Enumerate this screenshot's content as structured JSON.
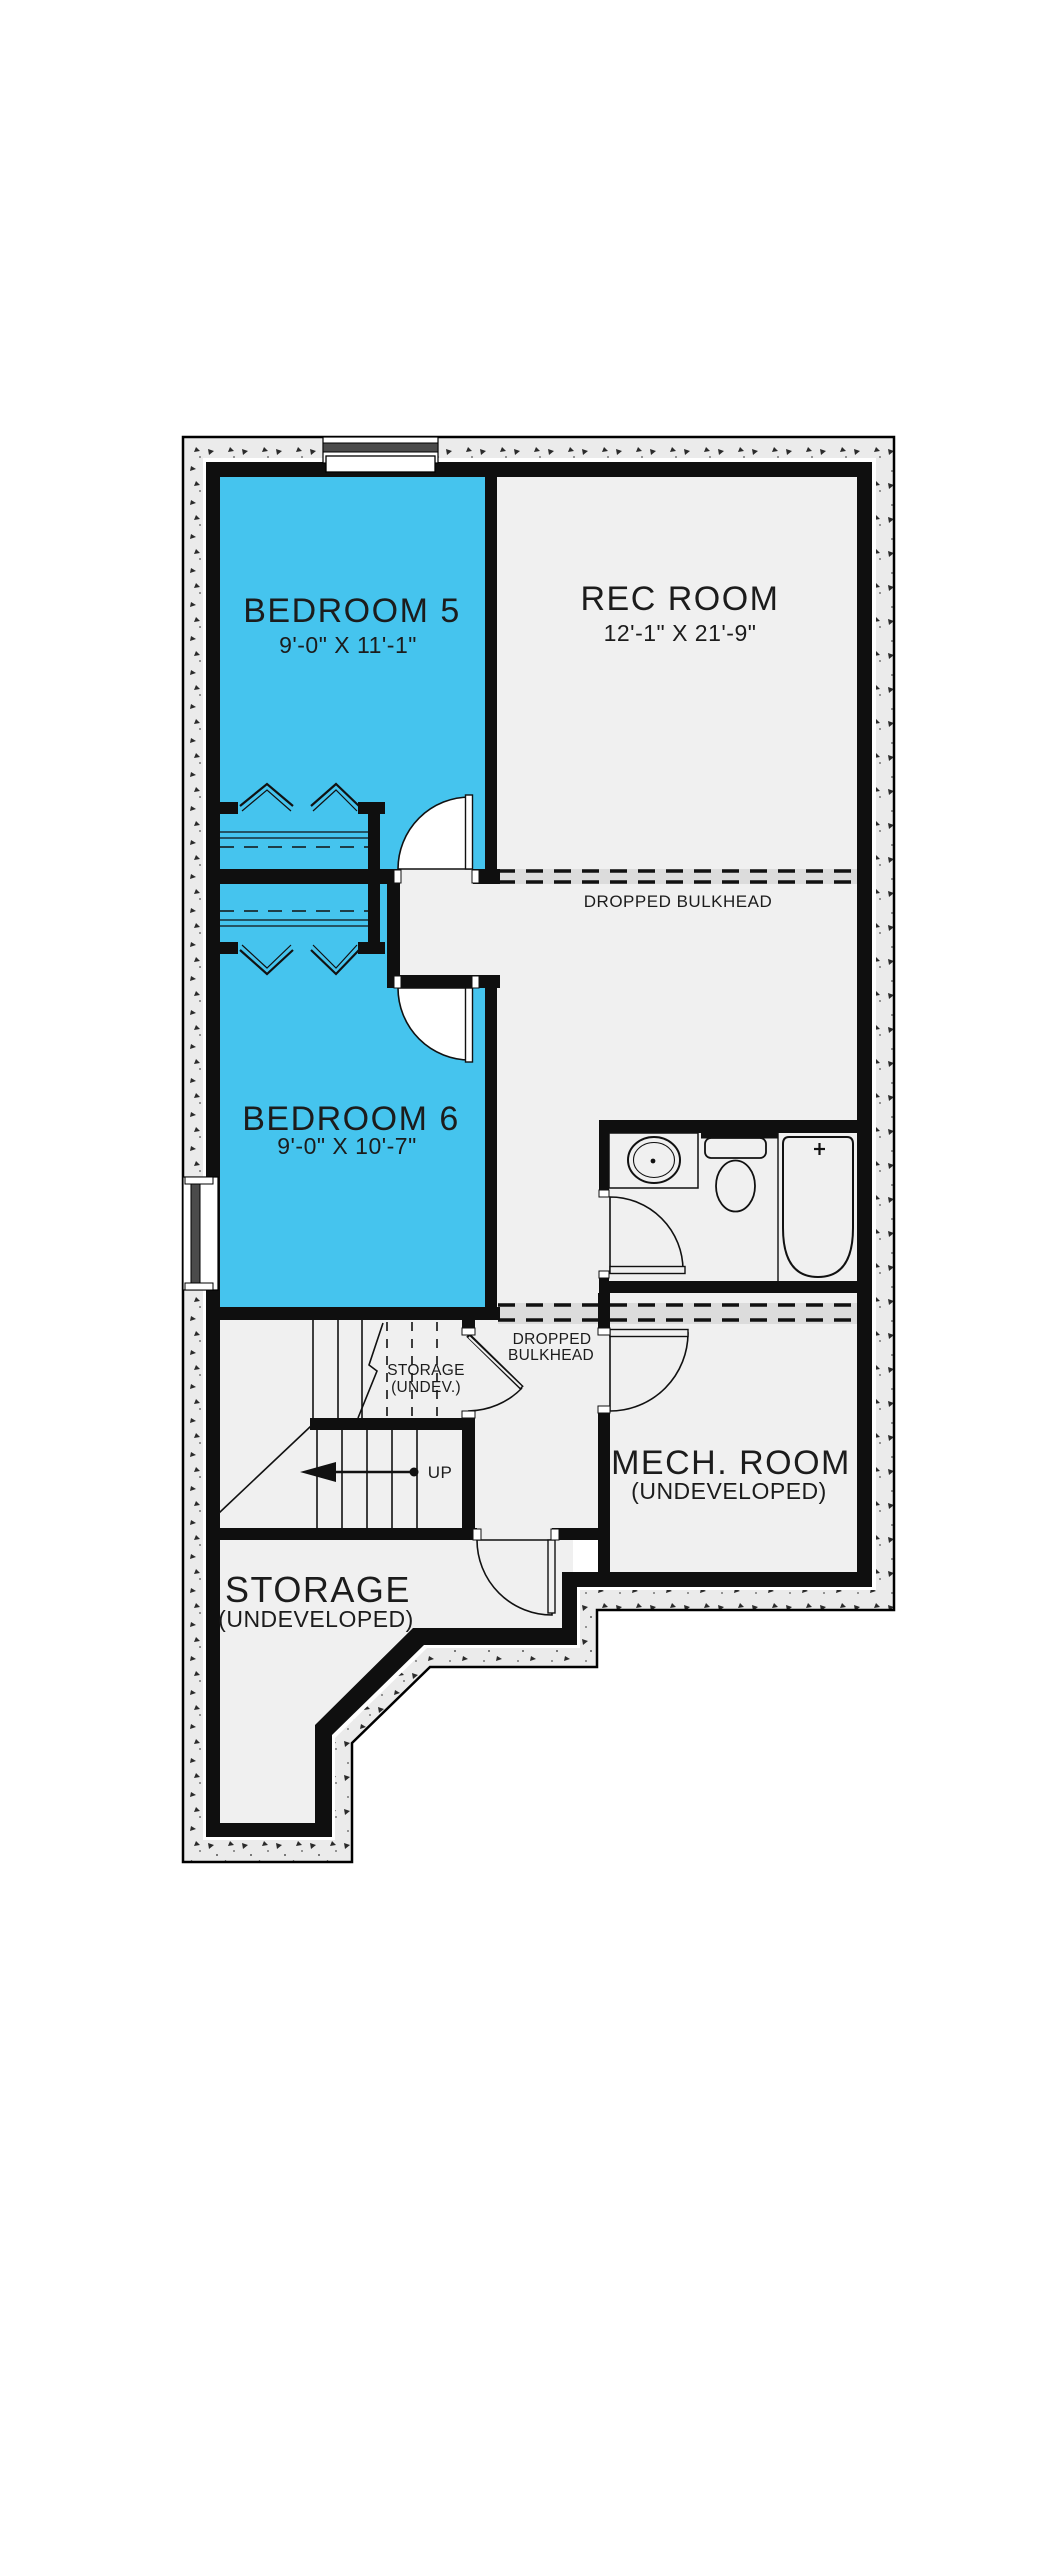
{
  "title": "Basement floor plan",
  "colors": {
    "highlight_blue": "#45C4EE",
    "floor_gray": "#F0F0F0",
    "wall_black": "#0F0F0F",
    "concrete": "#EBEBEB",
    "bulkhead_band": "#DCDCDC",
    "glazing_dark": "#4B4B4B"
  },
  "rooms": {
    "bedroom5": {
      "name": "BEDROOM 5",
      "dims": "9'-0\" X 11'-1\""
    },
    "rec_room": {
      "name": "REC ROOM",
      "dims": "12'-1\" X 21'-9\""
    },
    "bedroom6": {
      "name": "BEDROOM 6",
      "dims": "9'-0\" X 10'-7\""
    },
    "mech_room": {
      "name": "MECH. ROOM",
      "qualifier": "(UNDEVELOPED)"
    },
    "storage_main": {
      "name": "STORAGE",
      "qualifier": "(UNDEVELOPED)"
    },
    "storage_under_stairs": {
      "name": "STORAGE",
      "qualifier": "(UNDEV.)"
    }
  },
  "labels": {
    "dropped_bulkhead_upper": "DROPPED BULKHEAD",
    "dropped_bulkhead_lower_line1": "DROPPED",
    "dropped_bulkhead_lower_line2": "BULKHEAD",
    "stairs_up": "UP"
  }
}
